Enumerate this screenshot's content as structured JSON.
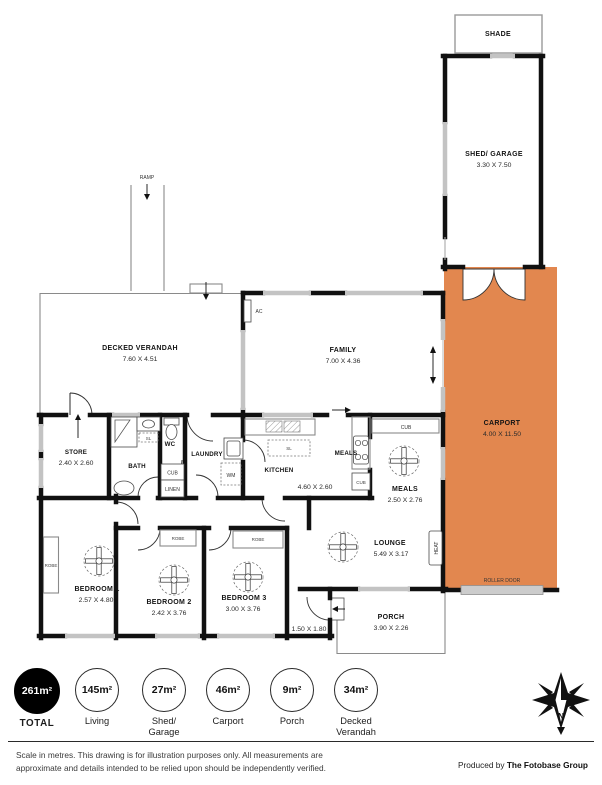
{
  "annotations": {
    "shade": "SHADE",
    "ramp": "RAMP",
    "ac": "AC",
    "heat": "HEAT",
    "roller_door": "ROLLER DOOR",
    "cub": "CUB",
    "linen": "LINEN",
    "robe": "ROBE",
    "wm": "WM",
    "sl": "SL",
    "north": "N"
  },
  "rooms": {
    "shed": {
      "name": "SHED/ GARAGE",
      "dims": "3.30 X 7.50"
    },
    "carport": {
      "name": "CARPORT",
      "dims": "4.00 X 11.50"
    },
    "verandah": {
      "name": "DECKED VERANDAH",
      "dims": "7.60 X 4.51"
    },
    "family": {
      "name": "FAMILY",
      "dims": "7.00 X 4.36"
    },
    "store": {
      "name": "STORE",
      "dims": "2.40 X 2.60"
    },
    "bath": {
      "name": "BATH"
    },
    "wc": {
      "name": "WC"
    },
    "laundry": {
      "name": "LAUNDRY"
    },
    "kitchen": {
      "name": "KITCHEN",
      "dims": "4.60 X 2.60"
    },
    "meals_nook": {
      "name": "MEALS"
    },
    "meals": {
      "name": "MEALS",
      "dims": "2.50 X 2.76"
    },
    "lounge": {
      "name": "LOUNGE",
      "dims": "5.49 X 3.17"
    },
    "porch": {
      "name": "PORCH",
      "dims": "3.90 X 2.26"
    },
    "bed1": {
      "name": "BEDROOM 1",
      "dims": "2.57 X 4.80"
    },
    "bed2": {
      "name": "BEDROOM 2",
      "dims": "2.42 X 3.76"
    },
    "bed3": {
      "name": "BEDROOM 3",
      "dims": "3.00 X 3.76"
    },
    "entry": {
      "dims": "1.50 X 1.80"
    }
  },
  "summary": {
    "items": [
      {
        "value": "261m²",
        "label": "TOTAL",
        "filled": true
      },
      {
        "value": "145m²",
        "label": "Living",
        "filled": false
      },
      {
        "value": "27m²",
        "label": "Shed/",
        "label2": "Garage",
        "filled": false
      },
      {
        "value": "46m²",
        "label": "Carport",
        "filled": false
      },
      {
        "value": "9m²",
        "label": "Porch",
        "filled": false
      },
      {
        "value": "34m²",
        "label": "Decked",
        "label2": "Verandah",
        "filled": false
      }
    ]
  },
  "footer": {
    "disclaimer_line1": "Scale in metres. This drawing is for illustration purposes only. All measurements are",
    "disclaimer_line2": "approximate and details intended to be relied upon should be independently verified.",
    "produced_by": "Produced by",
    "brand": "The Fotobase Group"
  },
  "colors": {
    "carport_fill": "#e2874f",
    "wall": "#111111",
    "window": "#c3c3c3"
  }
}
